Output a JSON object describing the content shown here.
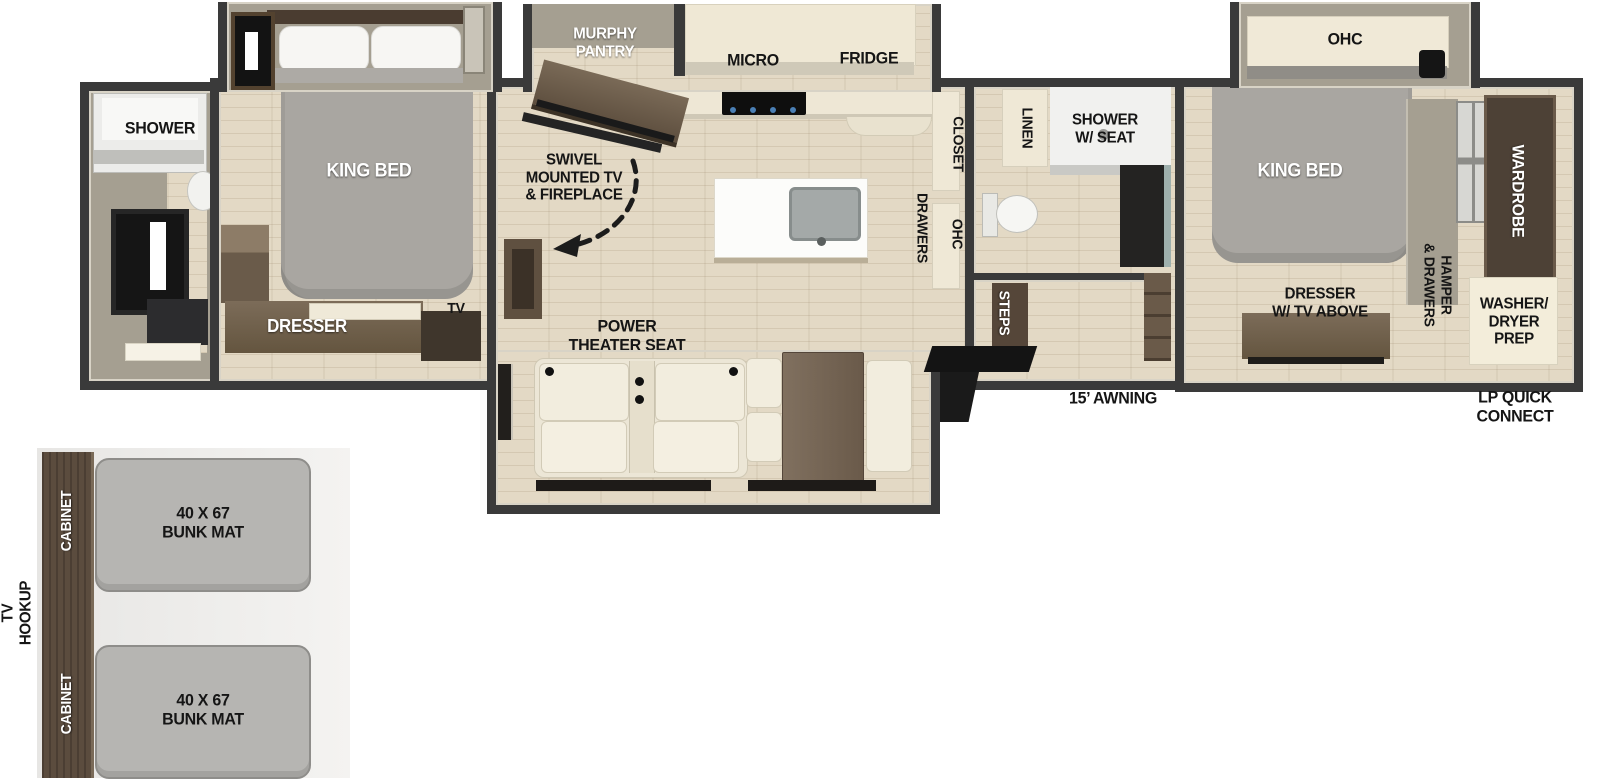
{
  "floorplan": {
    "rear_bath": {
      "shower": "SHOWER"
    },
    "bedroom_rear": {
      "king_bed": "KING BED",
      "dresser": "DRESSER",
      "tv": "TV"
    },
    "kitchen": {
      "murphy_pantry": "MURPHY\nPANTRY",
      "micro": "MICRO",
      "fridge": "FRIDGE",
      "closet": "CLOSET",
      "drawers": "DRAWERS",
      "ohc": "OHC"
    },
    "living": {
      "swivel_tv": "SWIVEL\nMOUNTED TV\n& FIREPLACE",
      "theater_seat": "POWER\nTHEATER SEAT"
    },
    "mid_bath": {
      "linen": "LINEN",
      "shower_w_seat": "SHOWER\nW/ SEAT",
      "steps": "STEPS"
    },
    "bedroom_front": {
      "ohc": "OHC",
      "king_bed": "KING BED",
      "wardrobe": "WARDROBE",
      "hamper_drawers": "HAMPER\n& DRAWERS",
      "dresser_tv": "DRESSER\nW/ TV ABOVE",
      "washer_dryer": "WASHER/\nDRYER\nPREP"
    },
    "exterior": {
      "awning": "15’ AWNING",
      "lp_quick_connect": "LP QUICK\nCONNECT"
    }
  },
  "bunk_inset": {
    "tv_hookup": "TV\nHOOKUP",
    "cabinet_upper": "CABINET",
    "cabinet_lower": "CABINET",
    "bunk_mat_upper": "40 X 67\nBUNK MAT",
    "bunk_mat_lower": "40 X 67\nBUNK MAT"
  },
  "colors": {
    "wall": "#3a3a3a",
    "floor": "#e3d9c5",
    "cream_cabinet": "#efe8d6",
    "brown_furniture": "#6e5e4d",
    "dark_brown": "#4d4136",
    "bed_gray": "#a9a6a1",
    "bunk_mat_gray": "#b6b5b2"
  }
}
